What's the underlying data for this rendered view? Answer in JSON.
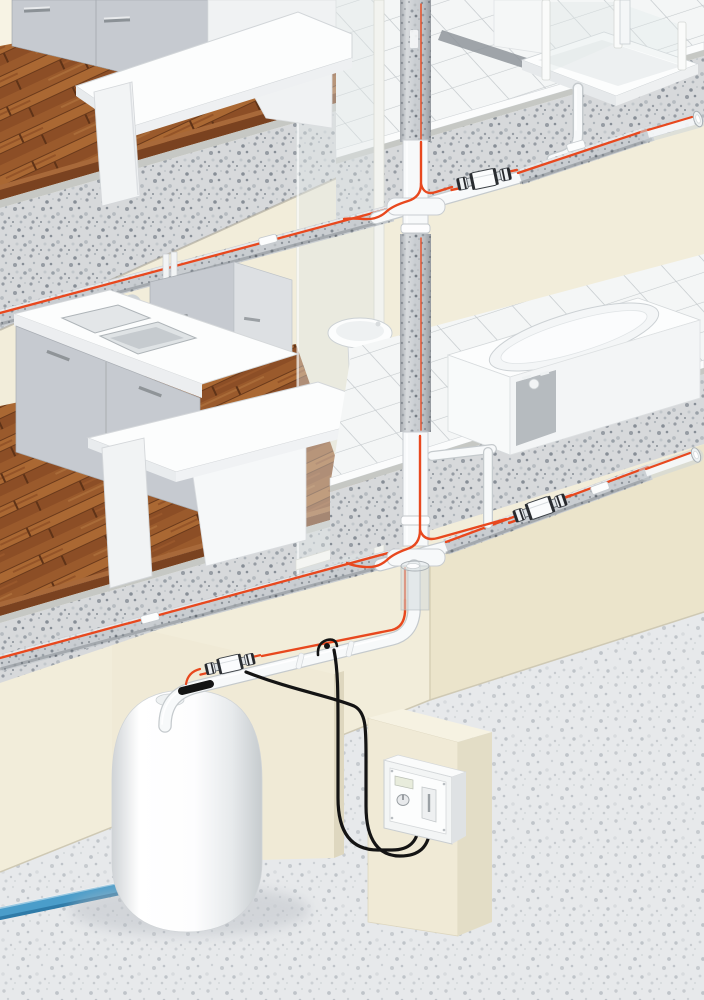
{
  "meta": {
    "type": "technical-illustration",
    "subject": "building-cutaway-hot-water-heat-tracing-system",
    "width_px": 704,
    "height_px": 1000
  },
  "palette": {
    "background": "#f2edda",
    "wall_shadow": "#ebe4cb",
    "wall_panel": "#f0ead6",
    "wall_panel_edge": "#ded7bf",
    "wood_dark": "#7a4220",
    "wood_mid": "#9a5a2c",
    "wood_light": "#a8693a",
    "concrete": "#d7d9db",
    "concrete_speckle": "#969ca3",
    "terrazzo": "#e7e9eb",
    "terrazzo_speckle": "#c7cbcf",
    "tile": "#f4f6f6",
    "tile_grout": "#c5cacd",
    "insulation": "#c9cdd1",
    "insulation_speckle": "#8d939a",
    "pipe_white": "#f7f9fa",
    "pipe_outline": "#c5cacd",
    "heating_cable": "#e8481e",
    "cold_water_pipe": "#4a9dca",
    "cold_water_dark": "#2f7ba8",
    "power_cable": "#141414",
    "fixture_white": "#fcfdfd",
    "cabinet_gray": "#c6cad0",
    "steel": "#c6cbcf",
    "glass": "rgba(223,232,232,0.42)"
  },
  "scene": {
    "floors": [
      {
        "id": "top-floor",
        "rooms": [
          {
            "id": "kitchen-top",
            "features": [
              "wood-floor",
              "kitchen-table",
              "base-cabinets"
            ]
          },
          {
            "id": "bathroom-top",
            "features": [
              "tile-floor",
              "shower-tray",
              "glass-enclosure",
              "drop-pipe"
            ]
          }
        ]
      },
      {
        "id": "middle-floor",
        "rooms": [
          {
            "id": "kitchen-middle",
            "features": [
              "wood-floor",
              "double-sink",
              "faucet",
              "base-cabinets",
              "wall-cabinet",
              "kitchen-table"
            ]
          },
          {
            "id": "bathroom-middle",
            "features": [
              "tile-platform",
              "bathtub",
              "pedestal-washbasin",
              "glass-partition"
            ]
          }
        ]
      },
      {
        "id": "utility-level",
        "rooms": [
          {
            "id": "utility-room",
            "features": [
              "terrazzo-floor",
              "water-heater",
              "controller-panel",
              "cold-water-inlet"
            ]
          }
        ]
      }
    ],
    "piping_system": {
      "riser_insulated": true,
      "heat_traced_runs": 5,
      "splice_connectors": 3,
      "end_terminations": 1,
      "sensor_probes": 1,
      "fixing_tape_tags": 4,
      "transparent_insulation_sleeves": 3,
      "heating_cable_color": "#e8481e",
      "cold_water_inlet_color": "#4a9dca",
      "power_cables": 2
    },
    "devices": {
      "water_heater": {
        "count": 1,
        "style": "white-cylinder-dome-top"
      },
      "controller": {
        "count": 1,
        "display": true,
        "dial": true,
        "switch": true,
        "mounted_on": "wall-board"
      }
    }
  }
}
